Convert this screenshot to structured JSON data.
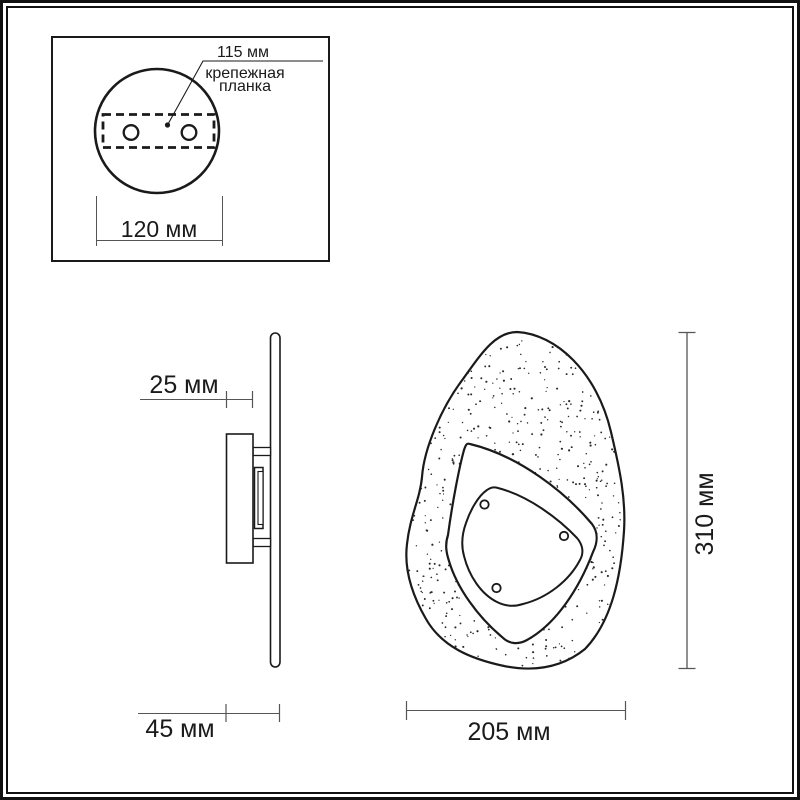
{
  "colors": {
    "line": "#1a1a1a",
    "dim_line": "#555555",
    "background": "#ffffff"
  },
  "inset": {
    "hole_spacing_dim": "115 мм",
    "plate_label_lines": [
      "крепежная",
      "планка"
    ],
    "base_width_dim": "120 мм"
  },
  "side_view": {
    "body_depth_dim": "25 мм",
    "total_depth_dim": "45 мм"
  },
  "front_view": {
    "width_dim": "205 мм",
    "height_dim": "310 мм"
  }
}
